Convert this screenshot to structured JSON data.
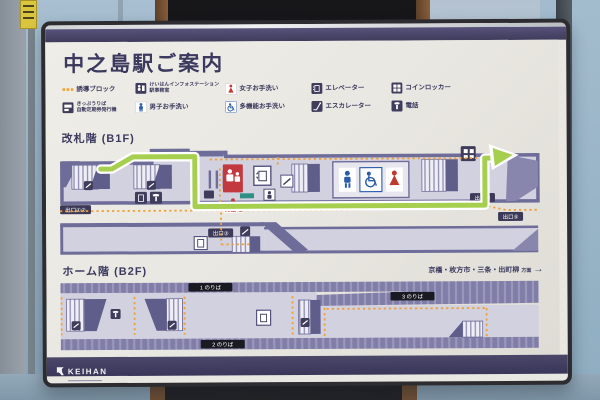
{
  "sign": {
    "title": "中之島駅ご案内",
    "legend": [
      {
        "icon": "tactile-paving-icon",
        "label": "誘導ブロック"
      },
      {
        "icon": "info-station-icon",
        "label": "けいはんインフォステーション",
        "label2": "駅事務室"
      },
      {
        "icon": "female-restroom-icon",
        "label": "女子お手洗い"
      },
      {
        "icon": "elevator-icon",
        "label": "エレベーター"
      },
      {
        "icon": "coin-locker-icon",
        "label": "コインロッカー"
      },
      {
        "icon": "ticket-machine-icon",
        "label": "きっぷうりば",
        "label2": "自動定期券発行機"
      },
      {
        "icon": "male-restroom-icon",
        "label": "男子お手洗い"
      },
      {
        "icon": "accessible-restroom-icon",
        "label": "多機能お手洗い"
      },
      {
        "icon": "escalator-icon",
        "label": "エスカレーター"
      },
      {
        "icon": "phone-icon",
        "label": "電話"
      }
    ],
    "b1f": {
      "section_title": "改札階 (B1F)",
      "current_location": "現在地",
      "exit_left": "出口①②",
      "exit_mid": "出口③",
      "exit_right1": "出口④",
      "exit_right2": "出口⑤"
    },
    "b2f": {
      "section_title": "ホーム階 (B2F)",
      "direction": "京橋・枚方市・三条・出町柳",
      "direction_suffix": "方面",
      "direction_arrow": "→",
      "platform1": "1 のりば",
      "platform2": "2 のりば",
      "platform3": "3 のりば"
    },
    "brand": "KEIHAN"
  },
  "colors": {
    "sign_navy": "#3f3c5c",
    "map_wall": "#6e6c99",
    "map_floor": "#d2d1e0",
    "route_green": "#a6cf4f",
    "tactile_orange": "#f0a031",
    "current_red": "#c23a3f",
    "male_blue": "#2b5ca9",
    "female_red": "#c0392f"
  }
}
